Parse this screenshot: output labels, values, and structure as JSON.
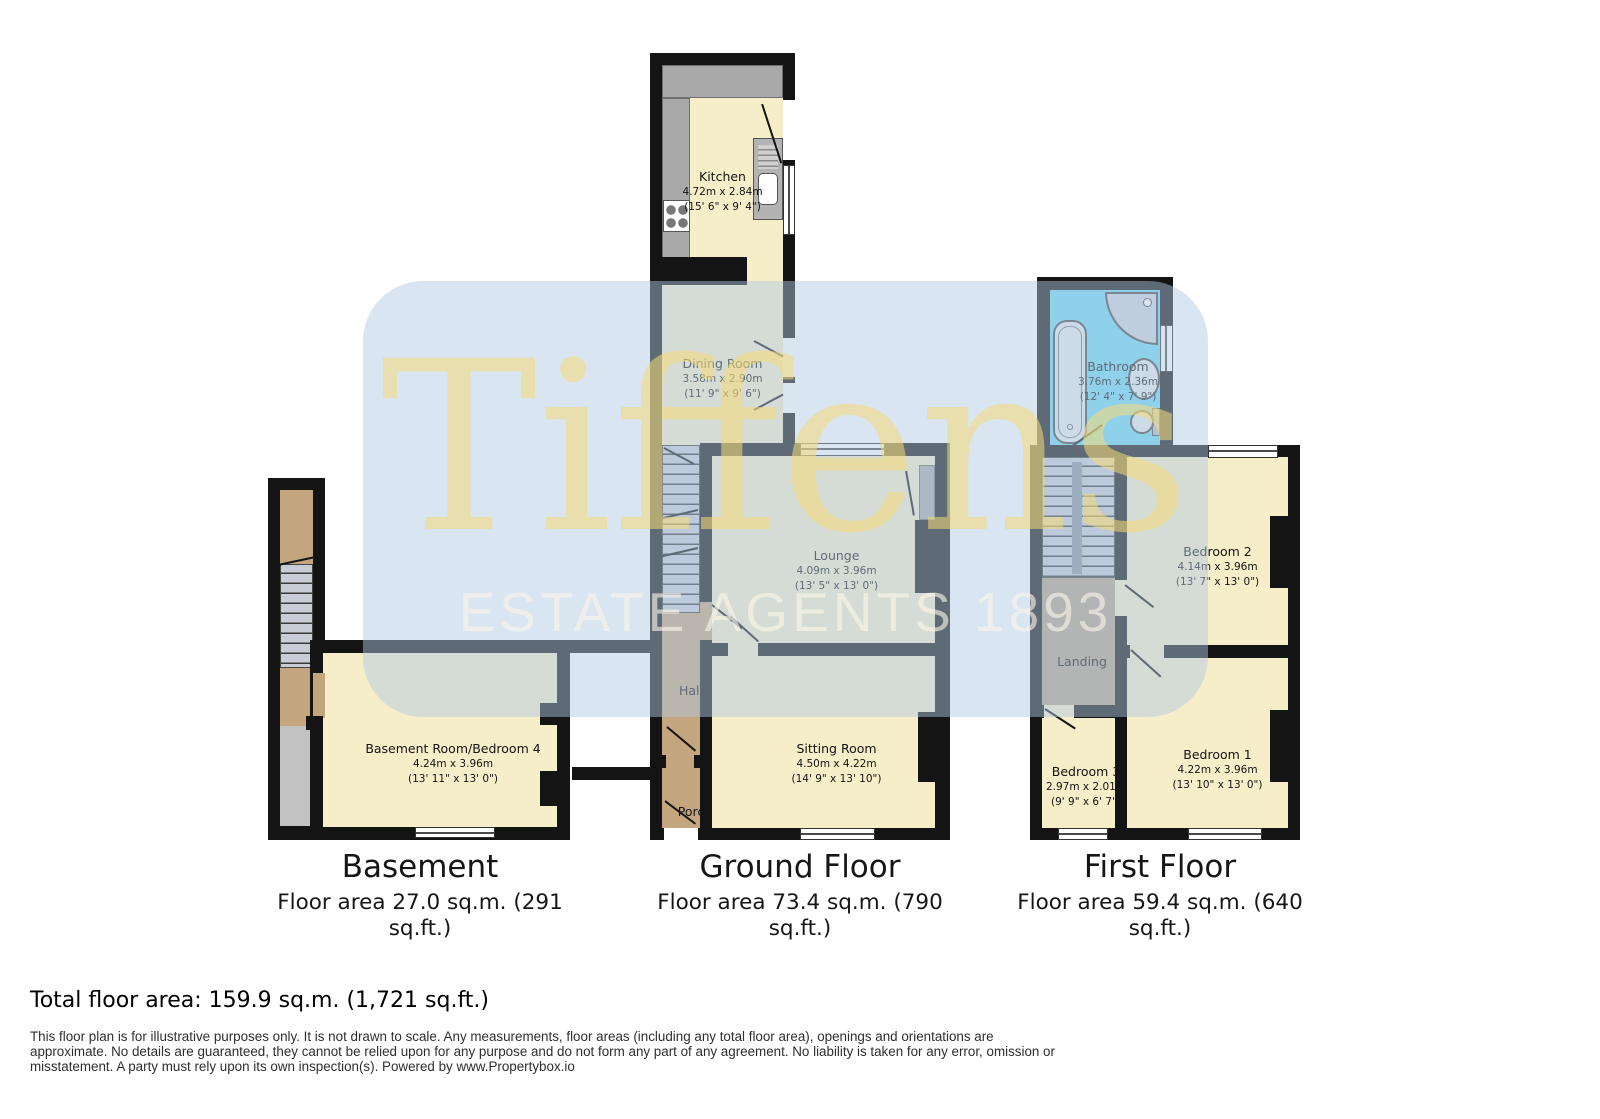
{
  "watermark": {
    "name": "Tiffens",
    "tagline": "ESTATE AGENTS 1893"
  },
  "floors": {
    "basement": {
      "title": "Basement",
      "area": "Floor area 27.0 sq.m. (291\nsq.ft.)"
    },
    "ground": {
      "title": "Ground Floor",
      "area": "Floor area 73.4 sq.m. (790\nsq.ft.)"
    },
    "first": {
      "title": "First Floor",
      "area": "Floor area 59.4 sq.m. (640\nsq.ft.)"
    }
  },
  "rooms": {
    "kitchen": {
      "name": "Kitchen",
      "m": "4.72m x 2.84m",
      "ft": "(15' 6\" x 9' 4\")"
    },
    "dining": {
      "name": "Dining Room",
      "m": "3.58m x 2.90m",
      "ft": "(11' 9\" x 9' 6\")"
    },
    "lounge": {
      "name": "Lounge",
      "m": "4.09m x 3.96m",
      "ft": "(13' 5\" x 13' 0\")"
    },
    "hall": {
      "name": "Hall"
    },
    "sitting": {
      "name": "Sitting Room",
      "m": "4.50m x 4.22m",
      "ft": "(14' 9\" x 13' 10\")"
    },
    "porch": {
      "name": "Porch"
    },
    "basement_room": {
      "name": "Basement Room/Bedroom 4",
      "m": "4.24m x 3.96m",
      "ft": "(13' 11\" x 13' 0\")"
    },
    "bathroom": {
      "name": "Bathroom",
      "m": "3.76m x 2.36m",
      "ft": "(12' 4\" x 7' 9\")"
    },
    "bedroom2": {
      "name": "Bedroom 2",
      "m": "4.14m x 3.96m",
      "ft": "(13' 7\" x 13' 0\")"
    },
    "landing": {
      "name": "Landing"
    },
    "bedroom3": {
      "name": "Bedroom 3",
      "m": "2.97m x 2.01m",
      "ft": "(9' 9\" x 6' 7\")"
    },
    "bedroom1": {
      "name": "Bedroom 1",
      "m": "4.22m x 3.96m",
      "ft": "(13' 10\" x 13' 0\")"
    }
  },
  "footer": {
    "total": "Total floor area: 159.9 sq.m. (1,721 sq.ft.)",
    "disclaimer": "This floor plan is for illustrative purposes only. It is not drawn to scale. Any measurements, floor areas (including any total floor area), openings and orientations are\napproximate. No details are guaranteed, they cannot be relied upon for any purpose and do not form any part of any agreement. No liability is taken for any error, omission or\nmisstatement. A party must rely upon its own inspection(s). Powered by www.Propertybox.io"
  },
  "colors": {
    "wall": "#141414",
    "room_cream": "#f6edc9",
    "hall_tan": "#c3a67e",
    "landing_tan": "#b7a28a",
    "bathroom_blue": "#72d6f2",
    "counter_gray": "#a9a9a9",
    "stairs_gray": "#c8ccd6",
    "slab_gray": "#c2c2c2",
    "watermark_blue": "rgba(175,200,226,0.48)",
    "watermark_yellow": "rgba(246,219,118,0.55)"
  }
}
